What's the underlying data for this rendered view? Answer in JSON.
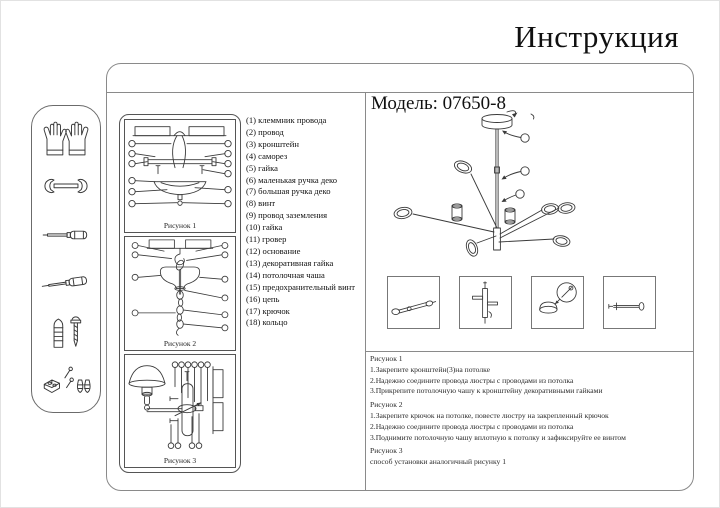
{
  "page": {
    "title": "Инструкция"
  },
  "model": {
    "label": "Модель: 07650-8"
  },
  "sidebar": {
    "tools": [
      "gloves",
      "wrench",
      "flat-screwdriver",
      "phillips-screwdriver",
      "dowel-and-screw",
      "fasteners"
    ]
  },
  "figures": {
    "fig1": {
      "label": "Рисунок 1"
    },
    "fig2": {
      "label": "Рисунок 2"
    },
    "fig3": {
      "label": "Рисунок 3"
    }
  },
  "parts": {
    "items": [
      "(1) клеммник провода",
      "(2) провод",
      "(3) кронштейн",
      "(4) саморез",
      "(5) гайка",
      "(6) маленькая ручка деко",
      "(7) большая ручка деко",
      "(8) винт",
      "(9) провод заземления",
      "(10) гайка",
      "(11) гровер",
      "(12) основание",
      "(13) декоративная гайка",
      "(14) потолочная чаша",
      "(15) предохранительный винт",
      "(16) цепь",
      "(17) крючок",
      "(18) кольцо"
    ]
  },
  "instructions": [
    {
      "heading": "Рисунок 1",
      "steps": [
        "1.Закрепите кронштейн(3)на потолке",
        "2.Надежно соедините провода люстры с проводами из потолка",
        "3.Прикрепите потолочную чашу к кронштейну декоративными гайками"
      ]
    },
    {
      "heading": "Рисунок 2",
      "steps": [
        "1.Закрепите крючок на потолке, повесте люстру на закрепленный крючок",
        "2.Надежно соедините провода люстры с проводами из потолка",
        "3.Поднимите потолочную чашу вплотную к потолку и зафиксируйте ее винтом"
      ]
    },
    {
      "heading": "Рисунок 3",
      "steps": [
        "способ установки аналогичный рисунку 1"
      ]
    }
  ]
}
